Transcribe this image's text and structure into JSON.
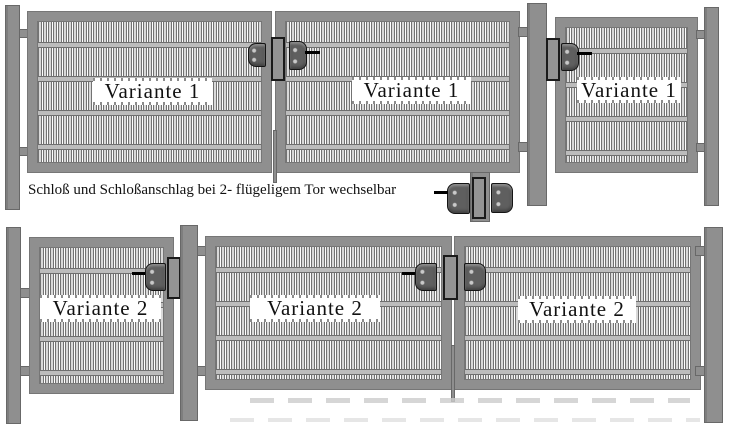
{
  "caption": {
    "text": "Schloß und Schloßanschlag bei 2- flügeligem Tor wechselbar"
  },
  "rows": {
    "top": {
      "double_gate": {
        "wing1_label": "Variante 1",
        "wing2_label": "Variante 1"
      },
      "single_gate": {
        "label": "Variante 1"
      }
    },
    "bottom": {
      "single_gate": {
        "label": "Variante 2"
      },
      "double_gate": {
        "wing1_label": "Variante 2",
        "wing2_label": "Variante 2"
      }
    }
  },
  "icons": {
    "lock_assembly": "lock-assembly-icon"
  },
  "colors": {
    "metal": "#8f8f8f",
    "metal_outline": "#686868",
    "mesh_bar": "#d9d9d9",
    "mesh_edge": "#737373",
    "rail_fill": "#bcbcbc",
    "lock_body": "#5f5f5f",
    "lock_outline": "#141414",
    "background": "#ffffff",
    "text": "#111111"
  }
}
